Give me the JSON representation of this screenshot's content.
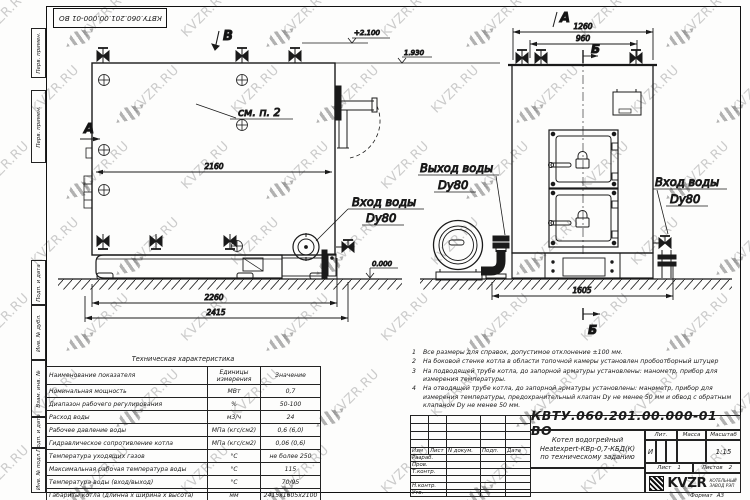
{
  "watermark": {
    "text": "KVZR.RU"
  },
  "sheet": {
    "margin_labels": [
      "Перв. примен.",
      "Перв. примен.",
      "Подп. и дата",
      "Инв. № дубл.",
      "Взам. инв. №",
      "Подп. и дата",
      "Инв. № подл."
    ]
  },
  "drawing": {
    "section_b_top": "В",
    "section_a_left": "А",
    "view_a_label": "А",
    "section_b_right": "Б",
    "section_b_bottom": "Б",
    "see_note": "см. п. 2",
    "inlet_line1": "Вход воды",
    "inlet_line2": "Dy80",
    "outlet_line1": "Выход воды",
    "outlet_line2": "Dy80",
    "dim_side_width": "2160",
    "dim_side_base": "2260",
    "dim_side_overall": "2415",
    "dim_front_top": "1260",
    "dim_front_inner": "960",
    "dim_front_base": "1605",
    "elev_valves": "+2.100",
    "elev_top": "1.930",
    "elev_ground": "0.000"
  },
  "notes": {
    "items": [
      {
        "num": "1",
        "text": "Все размеры для справок, допустимое отклонение ±100 мм."
      },
      {
        "num": "2",
        "text": "На боковой стенке котла в области топочной камеры установлен пробоотборный штуцер"
      },
      {
        "num": "3",
        "text": "На подводящей трубе котла, до запорной арматуры установлены: манометр, прибор для измерения температуры."
      },
      {
        "num": "4",
        "text": "На отводящей трубе котла, до запорной арматуры установлены: манометр, прибор для измерения температуры, предохранительный клапан Dу не менее 50 мм и обвод с обратным клапаном Dу не менее 50 мм."
      }
    ]
  },
  "spec_table": {
    "title": "Техническая характеристика",
    "headers": [
      "Наименование показателя",
      "Единицы измерения",
      "Значение"
    ],
    "rows": [
      [
        "Номинальная мощность",
        "МВт",
        "0,7"
      ],
      [
        "Диапазон рабочего регулирования",
        "%",
        "50-100"
      ],
      [
        "Расход воды",
        "м3/ч",
        "24"
      ],
      [
        "Рабочее давление воды",
        "МПа (кгс/см2)",
        "0,6 (6,0)"
      ],
      [
        "Гидравлическое сопротивление котла",
        "МПа (кгс/см2)",
        "0,06 (0,6)"
      ],
      [
        "Температура уходящих газов",
        "°С",
        "не более 250"
      ],
      [
        "Максимальная рабочая температура воды",
        "°С",
        "115"
      ],
      [
        "Температура воды (вход/выход)",
        "°С",
        "70/95"
      ],
      [
        "Габариты котла (длинна х ширина х высота)",
        "мм",
        "2415х1605х2100"
      ]
    ]
  },
  "title_block": {
    "doc_number": "КВТУ.060.201.00.000-01 ВО",
    "header_cols": [
      "Изм",
      "Лист",
      "N докум.",
      "Подп.",
      "Дата"
    ],
    "row_labels": [
      "Разраб.",
      "Пров.",
      "Т.контр.",
      "Н.контр.",
      "Утв."
    ],
    "title_line1": "Котел водогрейный",
    "title_line2": "Heatexpert-КВр-0,7-КБД(К)",
    "title_line3": "по техническому заданию",
    "lit_label": "Лит.",
    "lit_value": "И",
    "mass_label": "Масса",
    "scale_label": "Масштаб",
    "scale_value": "1:15",
    "sheet_label": "Лист",
    "sheet_value": "1",
    "sheets_label": "Листов",
    "sheets_value": "2",
    "format_label": "Формат",
    "format_value": "А3"
  },
  "logo": {
    "text": "KVZR",
    "caption_line1": "КОТЕЛЬНЫЙ",
    "caption_line2": "ЗАВОД РЭП"
  }
}
